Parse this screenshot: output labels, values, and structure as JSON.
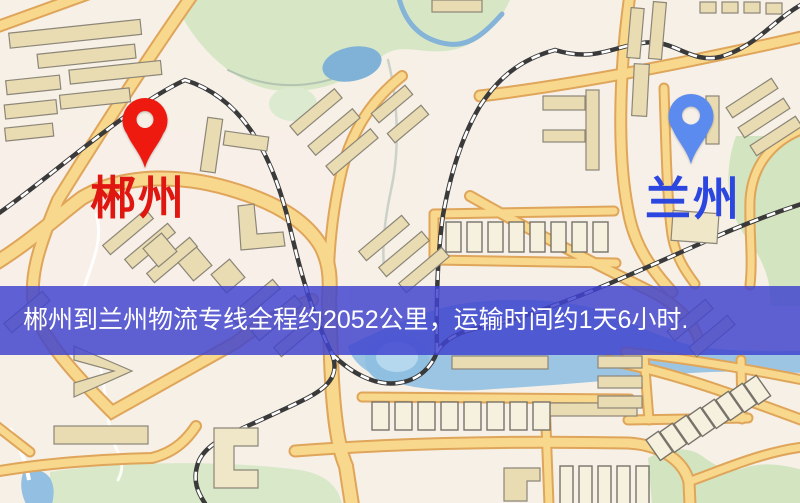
{
  "map": {
    "origin": {
      "label": "郴州",
      "pin_color": "#ee1a10",
      "label_color": "#e01711"
    },
    "destination": {
      "label": "兰州",
      "pin_color": "#5b8bee",
      "label_color": "#2b47e0"
    },
    "banner": {
      "text": "郴州到兰州物流专线全程约2052公里，运输时间约1天6小时.",
      "bg_rgba": "rgba(64,68,206,0.84)",
      "bg_hex": "#4044ce",
      "text_color": "#ffffff"
    },
    "palette": {
      "background": "#f6f0e7",
      "road_fill": "#f8d88c",
      "road_casing": "#dfa55a",
      "park_green": "#d7e7c5",
      "water_blue": "#9cc5e4",
      "railway_dark": "#3a3a3a"
    }
  }
}
